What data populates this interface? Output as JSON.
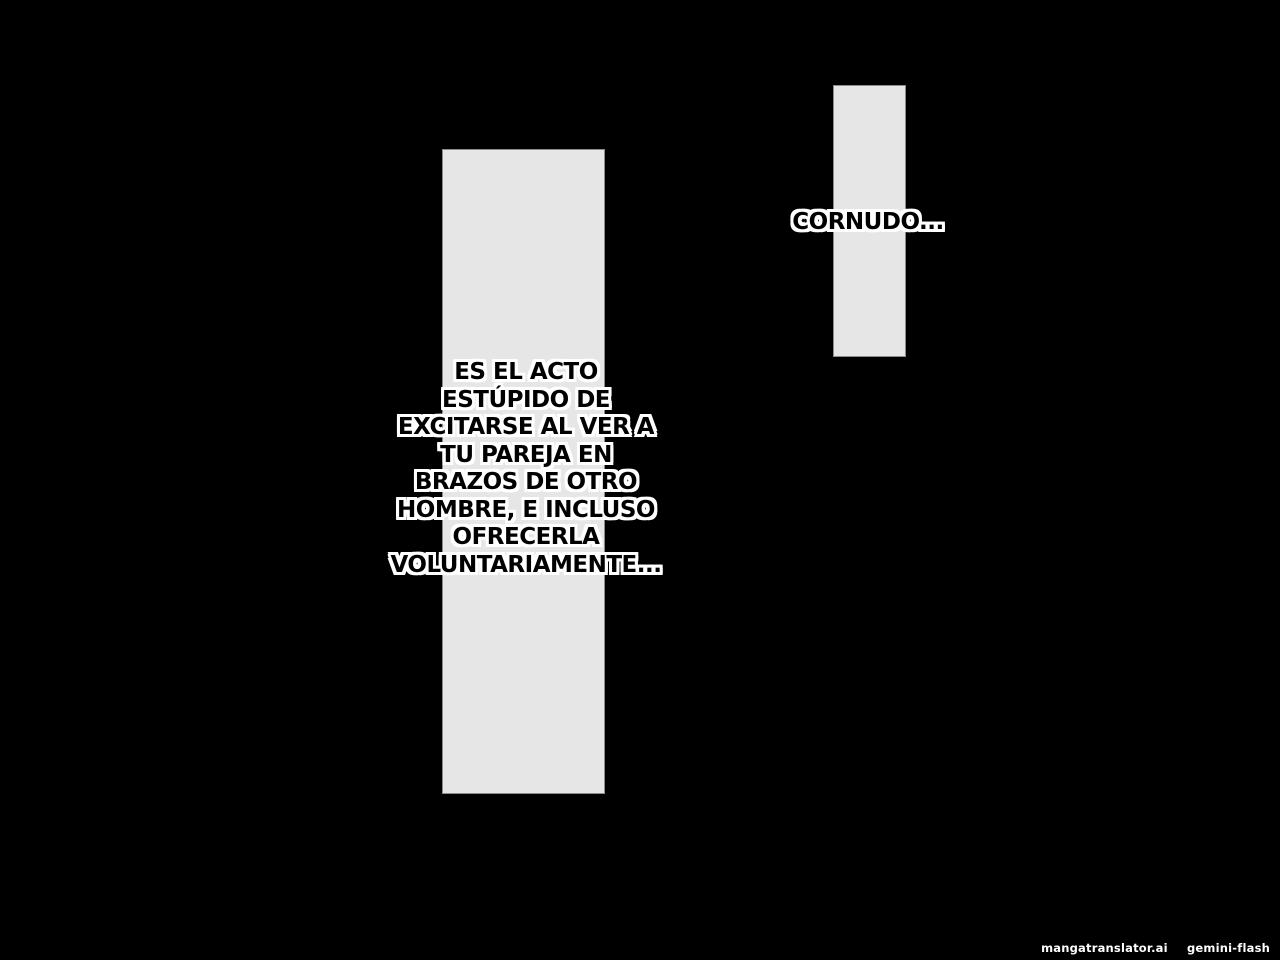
{
  "page": {
    "background_color": "#000000",
    "panel_fill_color": "#e6e6e6",
    "panel_border_color": "#8c8c8c",
    "speech_text_color": "#000000",
    "speech_outline_color": "#ffffff"
  },
  "speech": {
    "cornudo_text": "CORNUDO...",
    "main_lines": [
      "ES EL ACTO",
      "ESTÚPIDO DE",
      "EXCITARSE AL VER A",
      "TU PAREJA EN",
      "BRAZOS DE OTRO",
      "HOMBRE, E INCLUSO",
      "OFRECERLA",
      "VOLUNTARIAMENTE..."
    ]
  },
  "watermark": {
    "site": "mangatranslator.ai",
    "model": "gemini-flash"
  }
}
